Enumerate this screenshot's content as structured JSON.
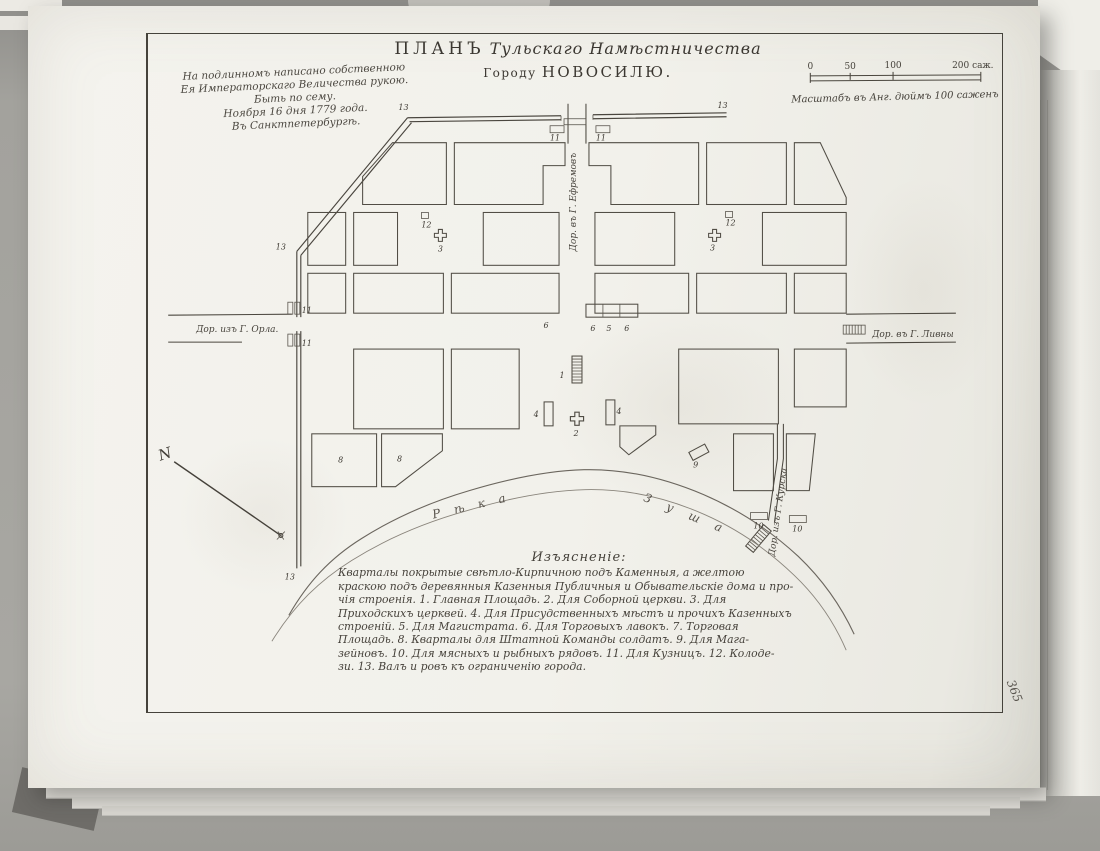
{
  "document": {
    "title_plan": "ПЛАНЪ",
    "title_script": "Тульскаго Намѣстничества",
    "title_city_prefix": "Городу",
    "title_city": "НОВОСИЛЮ.",
    "page_number": "365"
  },
  "imperial_note": {
    "lines": [
      "На подлинномъ написано собственною",
      "Ея Императорскаго Величества рукою.",
      "Быть по сему.",
      "Ноября 16 дня 1779 года.",
      "Въ Санктпетербургѣ."
    ]
  },
  "scale_bar": {
    "tick_0": "0",
    "tick_50": "50",
    "tick_100": "100",
    "tick_200": "200 саж.",
    "caption": "Масштабъ въ Анг. дюймъ 100 саженъ"
  },
  "roads": {
    "west": "Дор. изъ Г. Орла.",
    "east": "Дор. въ Г. Ливны",
    "north": "Дор. въ Г. Ефремовъ",
    "south": "Дор. изъ Г. Курска"
  },
  "river": {
    "name_first_word": "Рѣка",
    "name_second_word": "Зуша"
  },
  "compass": {
    "north_letter": "N"
  },
  "legend": {
    "title": "Изъясненіе:",
    "lines": [
      "Кварталы покрытые свѣтло-Кирпичною подъ Каменныя, а желтою",
      "краскою подъ деревянныя Казенныя Публичныя и Обывательскіе дома и про-",
      "чія строенія.  1. Главная Площадь.  2. Для Соборной церкви.  3. Для",
      "Приходскихъ церквей.  4. Для Присудственныхъ мѣстъ и прочихъ Казенныхъ",
      "строеній.  5. Для Магистрата.  6. Для Торговыхъ лавокъ.  7. Торговая",
      "Площадь.  8. Кварталы для Штатной Команды солдатъ.  9. Для Мага-",
      "зейновъ.  10. Для мясныхъ и рыбныхъ рядовъ.  11. Для Кузницъ.  12. Колоде-",
      "зи.  13. Валъ и ровъ къ ограниченію города."
    ]
  },
  "map_markers": [
    {
      "n": "13",
      "x": 404,
      "y": 110
    },
    {
      "n": "13",
      "x": 724,
      "y": 108
    },
    {
      "n": "13",
      "x": 281,
      "y": 250
    },
    {
      "n": "13",
      "x": 290,
      "y": 581
    },
    {
      "n": "11",
      "x": 556,
      "y": 141
    },
    {
      "n": "11",
      "x": 602,
      "y": 141
    },
    {
      "n": "11",
      "x": 307,
      "y": 314
    },
    {
      "n": "11",
      "x": 307,
      "y": 347
    },
    {
      "n": "12",
      "x": 427,
      "y": 228
    },
    {
      "n": "12",
      "x": 732,
      "y": 226
    },
    {
      "n": "3",
      "x": 441,
      "y": 252
    },
    {
      "n": "3",
      "x": 714,
      "y": 251
    },
    {
      "n": "1",
      "x": 563,
      "y": 379
    },
    {
      "n": "2",
      "x": 577,
      "y": 437
    },
    {
      "n": "4",
      "x": 537,
      "y": 418
    },
    {
      "n": "4",
      "x": 620,
      "y": 415
    },
    {
      "n": "5",
      "x": 610,
      "y": 332
    },
    {
      "n": "6",
      "x": 547,
      "y": 329
    },
    {
      "n": "6",
      "x": 594,
      "y": 332
    },
    {
      "n": "6",
      "x": 628,
      "y": 332
    },
    {
      "n": "8",
      "x": 341,
      "y": 464
    },
    {
      "n": "8",
      "x": 400,
      "y": 463
    },
    {
      "n": "9",
      "x": 697,
      "y": 469
    },
    {
      "n": "10",
      "x": 760,
      "y": 530
    },
    {
      "n": "10",
      "x": 799,
      "y": 533
    }
  ]
}
